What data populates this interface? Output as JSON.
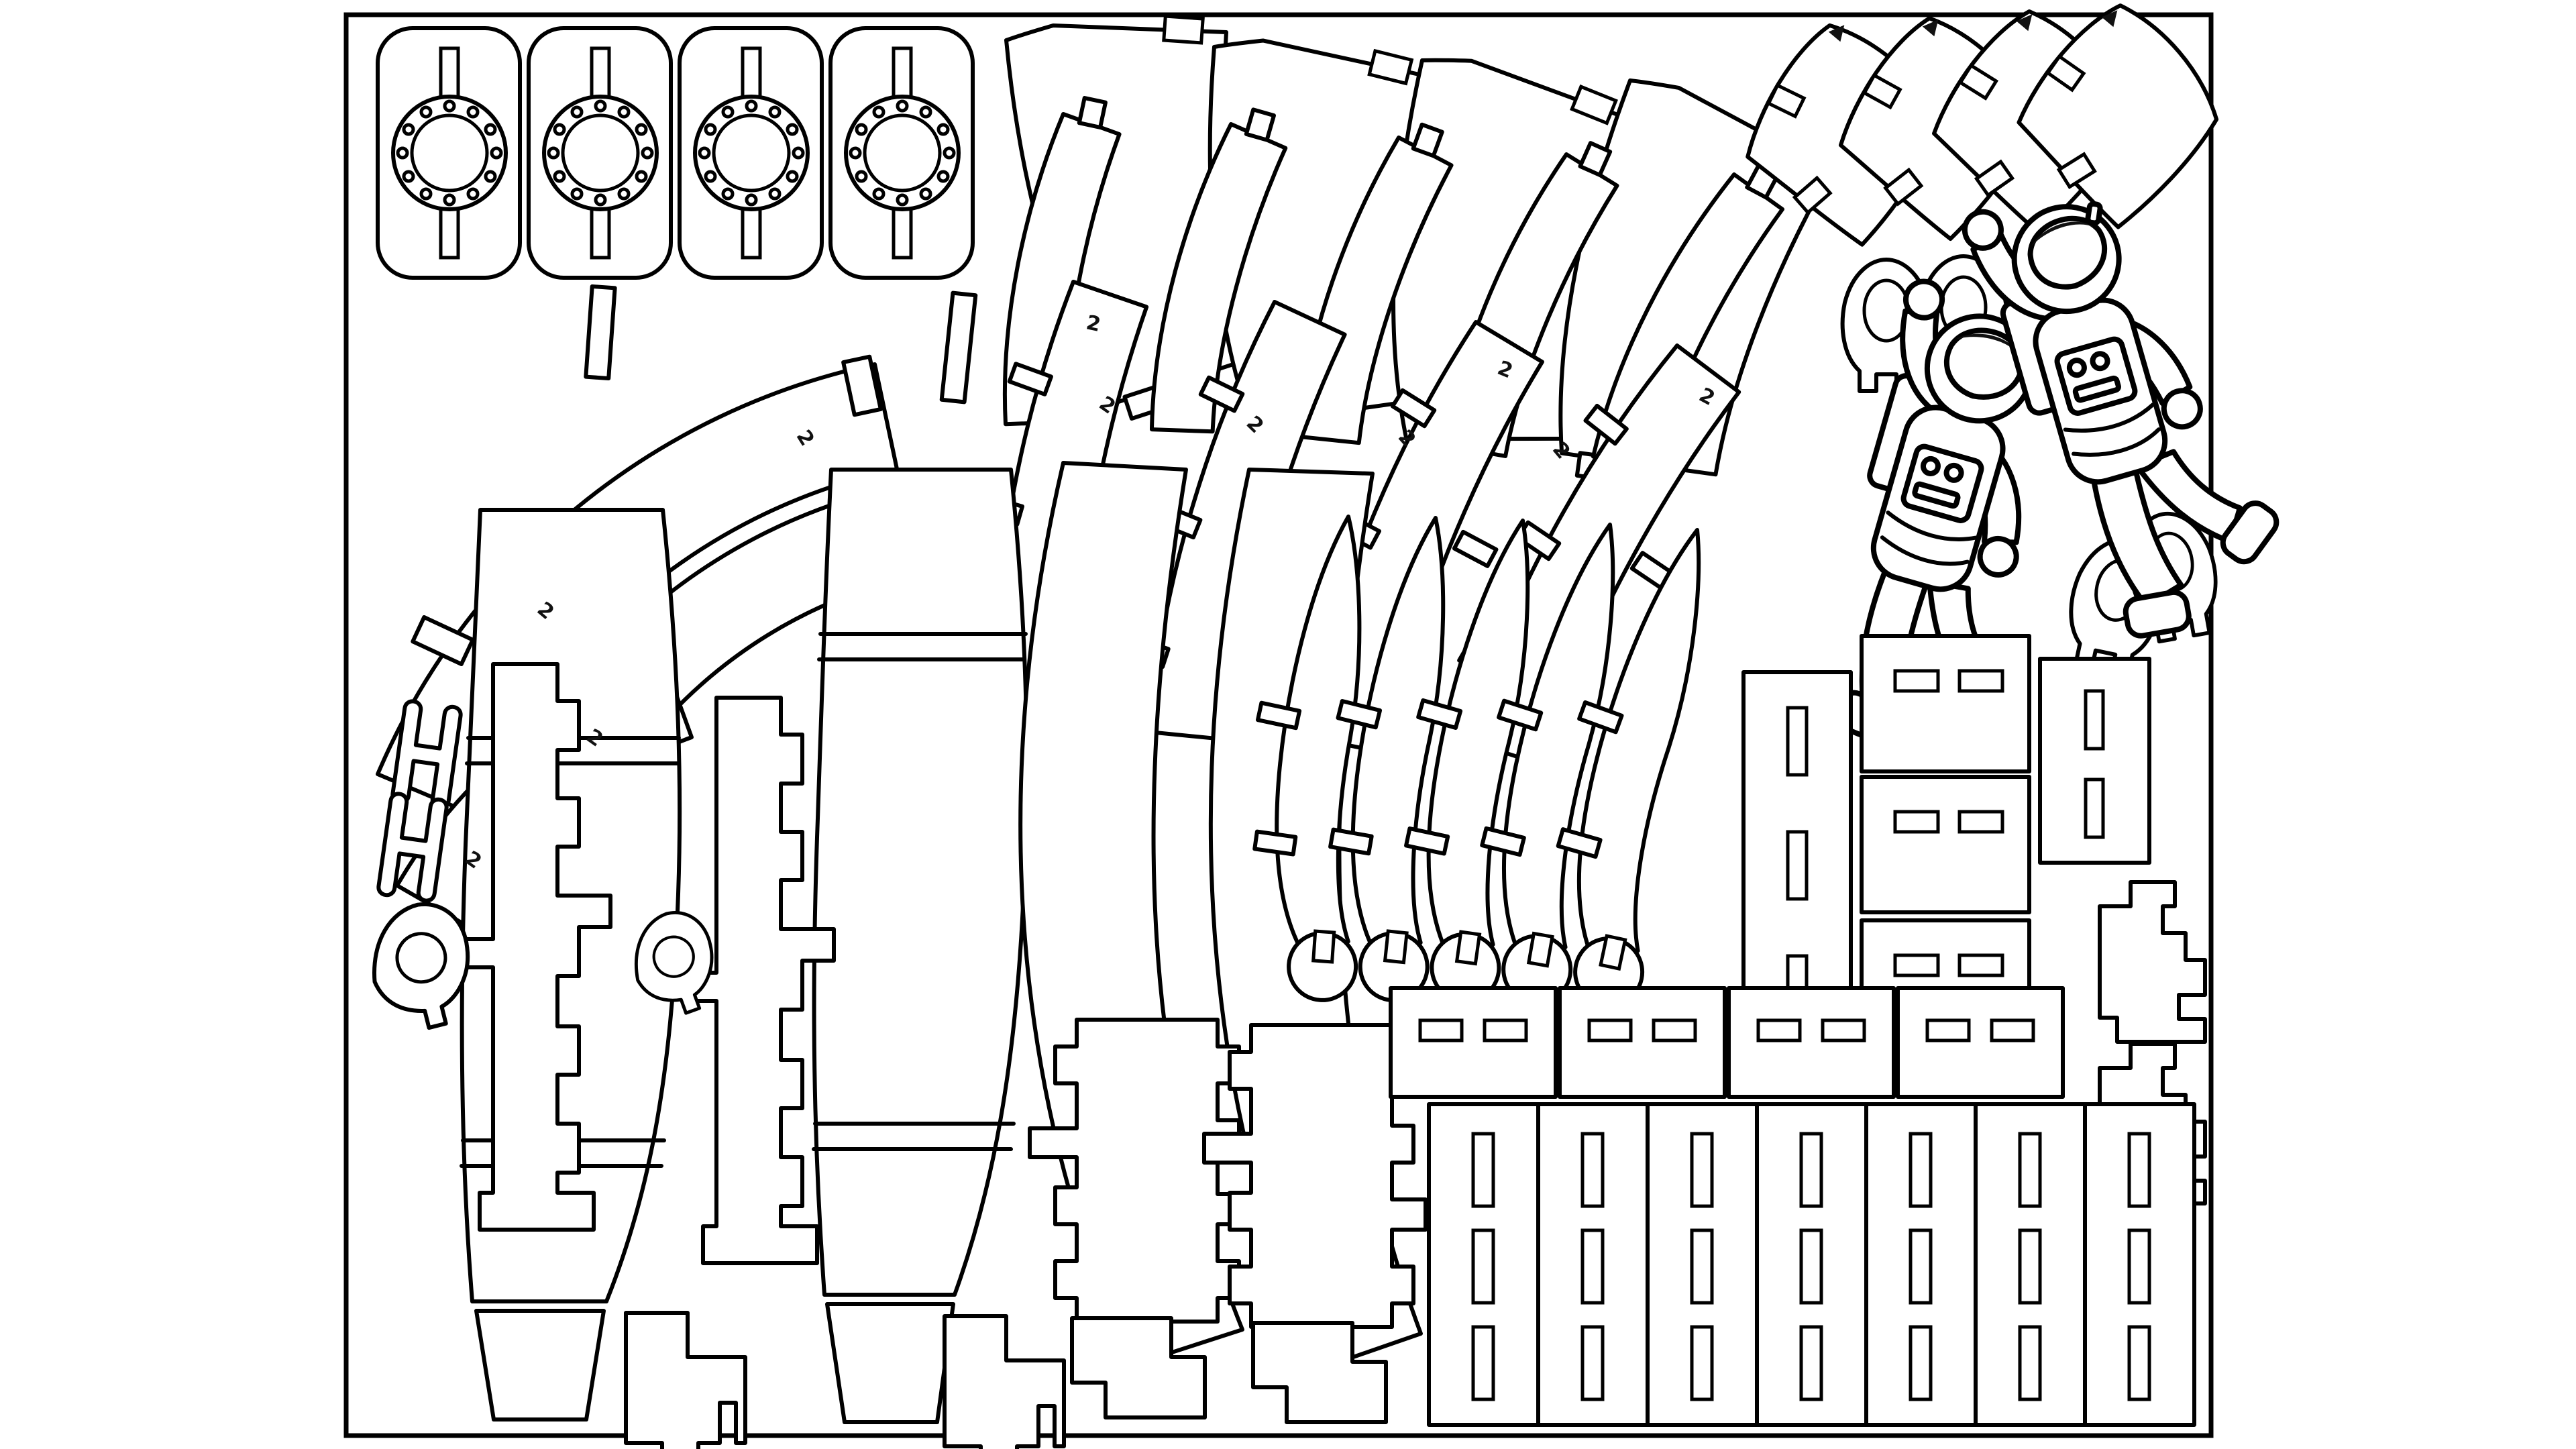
{
  "sheet": {
    "kind": "laser-cut pattern sheet",
    "subject": "3D rocket model kit parts with two astronaut figures",
    "background_color": "#ffffff",
    "cut_line_color": "#000000",
    "engrave_color": "#111111",
    "border_present": true
  },
  "labels": {
    "part_number": "2",
    "arrow": "▲"
  },
  "inventory": [
    {
      "piece": "porthole-plate",
      "count": 4,
      "description": "rounded rectangle with bolt-circle flange and two slots"
    },
    {
      "piece": "nose-cone-gore",
      "count": 4,
      "description": "large curved fan segment"
    },
    {
      "piece": "ring-strip",
      "count": 5,
      "description": "thin curved ring segment"
    },
    {
      "piece": "tab-strip",
      "count": 4,
      "description": "curved ring segment with T-tabs"
    },
    {
      "piece": "saddle-shell",
      "count": 4,
      "description": "curved kite-shaped shell with notches and arrow engraving"
    },
    {
      "piece": "arc-rib",
      "count": 3,
      "description": "large annular arc rib with tabs"
    },
    {
      "piece": "body-panel-stack",
      "count": 2,
      "description": "tall curved side panel with divider cuts and bucket base"
    },
    {
      "piece": "castellated-spar",
      "count": 2,
      "description": "single-sided stepped spar strip"
    },
    {
      "piece": "double-castellated-spar",
      "count": 2,
      "description": "double-sided stepped spar strip"
    },
    {
      "piece": "spine-panel",
      "count": 2,
      "description": "wide curved parenthesis panel"
    },
    {
      "piece": "fin-blade",
      "count": 5,
      "description": "curved blade with omega foot and tabs"
    },
    {
      "piece": "h-link",
      "count": 2,
      "description": "H-shaped connector"
    },
    {
      "piece": "keyhole-clip",
      "count": 2,
      "description": "teardrop clip with round hole and notch"
    },
    {
      "piece": "omega-clip",
      "count": 4,
      "description": "padlock-shaped clip with round hole and bottom notch"
    },
    {
      "piece": "tab-key",
      "count": 2,
      "description": "small rectangular key tab"
    },
    {
      "piece": "tall-slot-box",
      "count": 1,
      "description": "tall rectangle with three vertical slots"
    },
    {
      "piece": "stacked-slot-box",
      "count": 3,
      "description": "rectangle with two horizontal slots"
    },
    {
      "piece": "vertical-slot-box",
      "count": 1,
      "description": "rectangle with two vertical slots"
    },
    {
      "piece": "stair-bracket",
      "count": 2,
      "description": "stepped staircase bracket"
    },
    {
      "piece": "wide-slot-box",
      "count": 4,
      "description": "wide rectangle with two horizontal slots"
    },
    {
      "piece": "slot-column",
      "count": 7,
      "description": "tall column with three vertical slots"
    },
    {
      "piece": "boot-bracket",
      "count": 2,
      "description": "boot-shaped stepped bracket"
    },
    {
      "piece": "l-foot",
      "count": 2,
      "description": "L-shaped stepped foot"
    },
    {
      "piece": "astronaut-figure",
      "count": 2,
      "description": "engraved floating astronaut line art"
    }
  ]
}
